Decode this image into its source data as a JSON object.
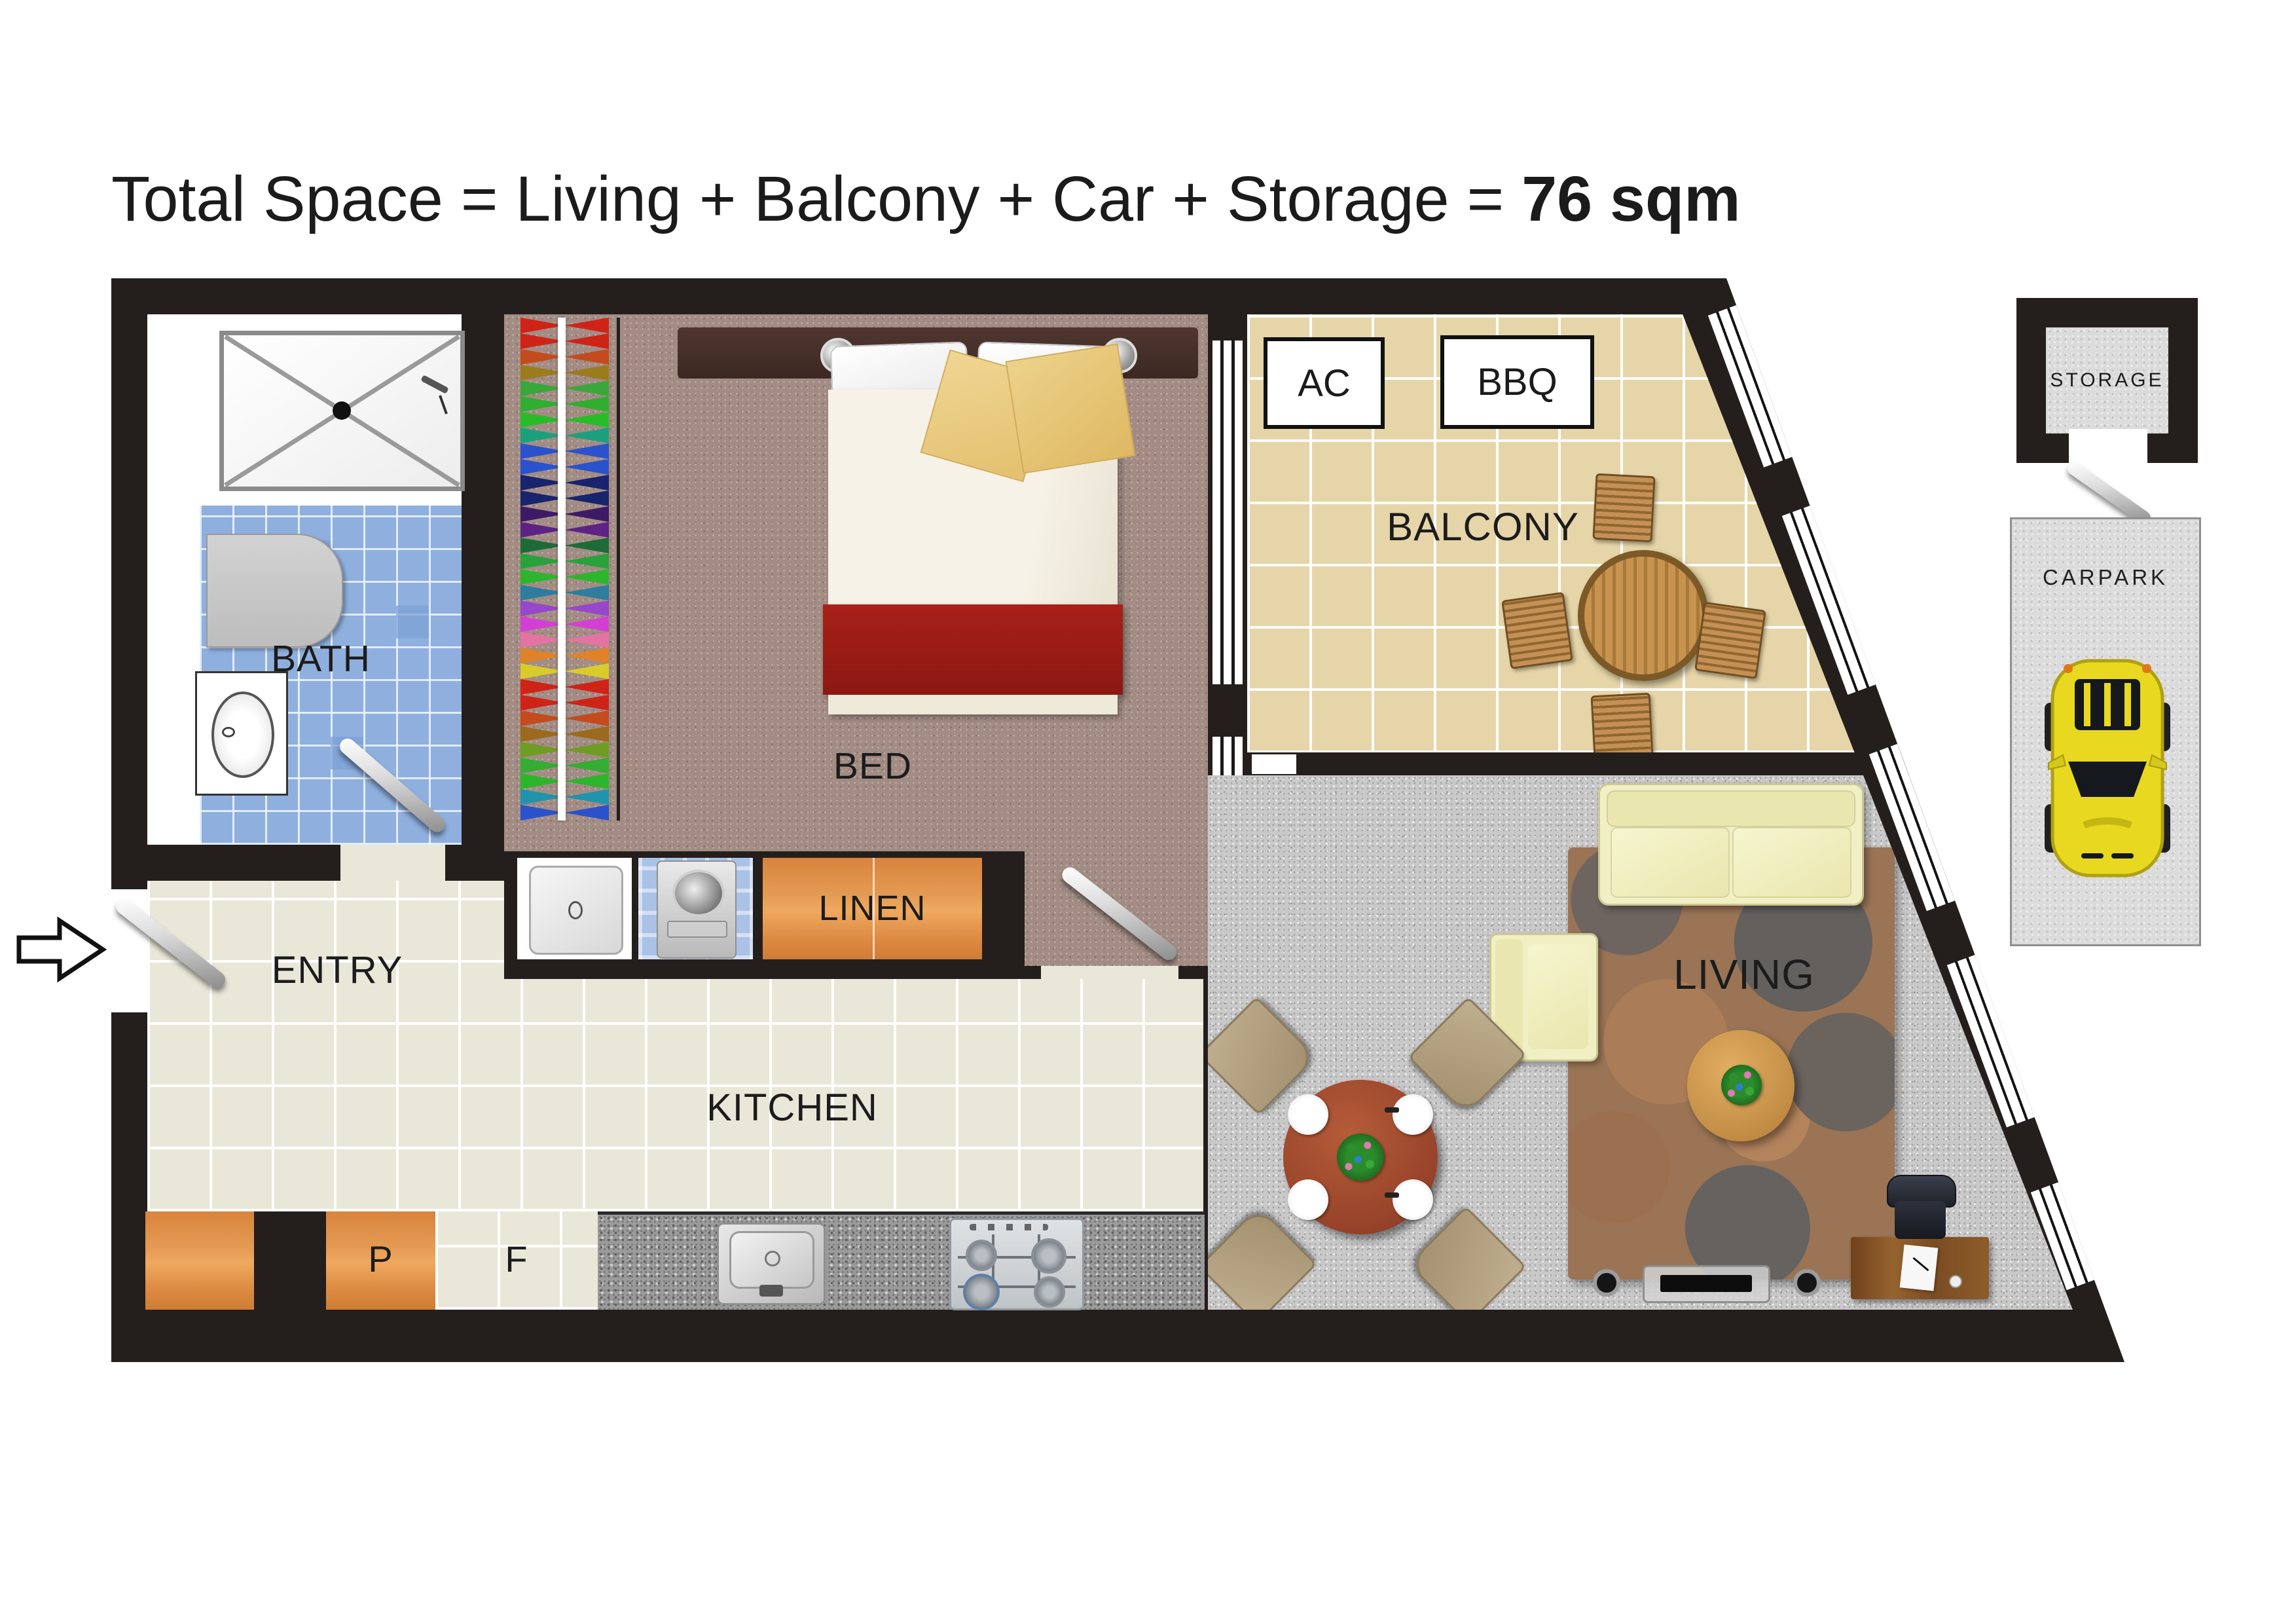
{
  "title": {
    "prefix": "Total Space = Living + Balcony + Car + Storage = ",
    "total": "76 sqm"
  },
  "labels": {
    "bath": "BATH",
    "bed": "BED",
    "linen": "LINEN",
    "entry": "ENTRY",
    "kitchen": "KITCHEN",
    "balcony": "BALCONY",
    "living": "LIVING",
    "ac": "AC",
    "bbq": "BBQ",
    "pantry": "P",
    "fridge": "F",
    "storage": "STORAGE",
    "carpark": "CARPARK"
  },
  "icons": {
    "entry_arrow": "right-arrow",
    "door_handles": "chrome-door-handle",
    "shower": "shower-tray-with-drain",
    "car": "yellow-sports-car-top-view"
  },
  "colors": {
    "wall": "#241f1d",
    "bath_tile": "#8fb0df",
    "bedroom_carpet": "#a28c84",
    "balcony_tile": "#e6d5a8",
    "kitchen_tile": "#e9e7d8",
    "living_carpet": "#c9c9c9",
    "granite_bench": "#9b9b9b",
    "cabinet_wood": "#e0903f",
    "bed_runner_red": "#9c1d15",
    "sofa_cream": "#f1efc4",
    "dining_table": "#97432a",
    "car_yellow": "#e8d820",
    "rug_brown": "#9a7455"
  },
  "wardrobe": {
    "colors": [
      "#d02318",
      "#d02318",
      "#c44b1d",
      "#9b7b1c",
      "#3aa73a",
      "#2fae2f",
      "#29bc29",
      "#1ba07e",
      "#2a52cc",
      "#2a52cc",
      "#18246e",
      "#18246e",
      "#3d1a66",
      "#5c2385",
      "#1d6b38",
      "#2aa23c",
      "#2eb52e",
      "#2e7d9e",
      "#9747c9",
      "#d43ed4",
      "#e473a3",
      "#e08228",
      "#d9cb2a",
      "#d02318",
      "#d02318",
      "#c44b1d",
      "#9b6a1c",
      "#6f9c22",
      "#33ad33",
      "#2bb62b",
      "#1f94ac",
      "#2a52cc"
    ]
  }
}
